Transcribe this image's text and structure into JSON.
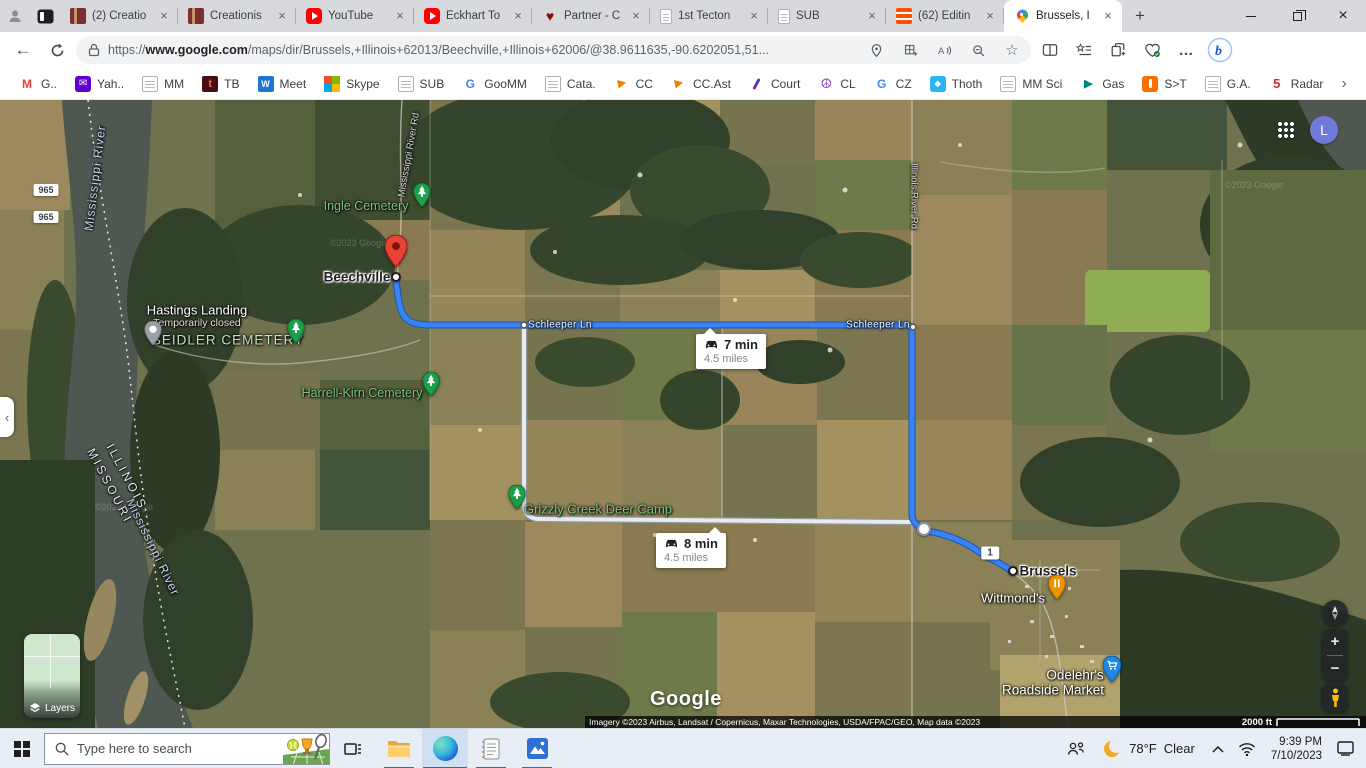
{
  "browser": {
    "tabs": [
      {
        "title": "(2) Creatio",
        "icon": "creation"
      },
      {
        "title": "Creationis",
        "icon": "creation"
      },
      {
        "title": "YouTube",
        "icon": "youtube"
      },
      {
        "title": "Eckhart To",
        "icon": "youtube"
      },
      {
        "title": "Partner - C",
        "icon": "heart"
      },
      {
        "title": "1st Tecton",
        "icon": "page"
      },
      {
        "title": "SUB",
        "icon": "page"
      },
      {
        "title": "(62) Editin",
        "icon": "flip"
      },
      {
        "title": "Brussels, I",
        "icon": "maps",
        "active": true
      }
    ],
    "glyphs": {
      "close": "×",
      "new_tab": "+",
      "back_arrow": "←",
      "overflow_dots": "…",
      "bookmarks_more": "›",
      "side_panel_collapse": "‹",
      "star": "☆",
      "split_screen": "◫"
    },
    "url": {
      "scheme": "https://",
      "host": "www.google.com",
      "path": "/maps/dir/Brussels,+Illinois+62013/Beechville,+Illinois+62006/@38.9611635,-90.6202051,51..."
    },
    "bing_label": "b",
    "bookmarks": [
      {
        "label": "G..",
        "icon": "gmail"
      },
      {
        "label": "Yah..",
        "icon": "mail-purple"
      },
      {
        "label": "MM",
        "icon": "page"
      },
      {
        "label": "TB",
        "icon": "tb"
      },
      {
        "label": "Meet",
        "icon": "w-blue"
      },
      {
        "label": "Skype",
        "icon": "ms"
      },
      {
        "label": "SUB",
        "icon": "page"
      },
      {
        "label": "GooMM",
        "icon": "google-g"
      },
      {
        "label": "Cata.",
        "icon": "page"
      },
      {
        "label": "CC",
        "icon": "arrow-orange"
      },
      {
        "label": "CC.Ast",
        "icon": "arrow-orange"
      },
      {
        "label": "Court",
        "icon": "feather"
      },
      {
        "label": "CL",
        "icon": "peace"
      },
      {
        "label": "CZ",
        "icon": "google-g"
      },
      {
        "label": "Thoth",
        "icon": "thoth"
      },
      {
        "label": "MM Sci",
        "icon": "page"
      },
      {
        "label": "Gas",
        "icon": "gas"
      },
      {
        "label": "S>T",
        "icon": "st"
      },
      {
        "label": "G.A.",
        "icon": "page"
      },
      {
        "label": "Radar",
        "icon": "five"
      }
    ]
  },
  "map": {
    "labels": {
      "mississippi_river": "Mississippi River",
      "mississippi_river_rd": "Mississippi River Rd",
      "illinois_river_rd": "Illinois River Rd",
      "ingle_cemetery": "Ingle Cemetery",
      "beechville": "Beechville",
      "hastings_landing": "Hastings Landing",
      "hastings_status": "Temporarily closed",
      "seidler_cemetery": "SEIDLER CEMETERY",
      "harrell_kirn_cemetery": "Harrell-Kirn Cemetery",
      "illinois": "ILLINOIS",
      "missouri": "MISSOURI",
      "schleeper_ln": "Schleeper Ln",
      "grizzly_creek": "Grizzly Creek Deer Camp",
      "brussels": "Brussels",
      "wittmonds": "Wittmond's",
      "odelehrs_line1": "Odelehr's",
      "odelehrs_line2": "Roadside Market"
    },
    "shields": {
      "route_965": "965",
      "route_1": "1"
    },
    "routes": {
      "primary": {
        "duration": "7 min",
        "distance": "4.5 miles"
      },
      "alternate": {
        "duration": "8 min",
        "distance": "4.5 miles"
      }
    },
    "controls": {
      "layers_label": "Layers",
      "zoom_in": "+",
      "zoom_out": "−"
    },
    "google_logo": "Google",
    "avatar_initial": "L",
    "attribution": {
      "imagery": "Imagery ©2023 Airbus, Landsat / Copernicus, Maxar Technologies, USDA/FPAC/GEO, Map data ©2023",
      "links": [
        "United States",
        "Terms",
        "Privacy",
        "Send feedback"
      ],
      "scale_text": "2000 ft"
    },
    "watermark": "©2023 Google"
  },
  "taskbar": {
    "search_placeholder": "Type here to search",
    "weather": {
      "temp": "78°F",
      "condition": "Clear"
    },
    "clock": {
      "time": "9:39 PM",
      "date": "7/10/2023"
    }
  },
  "colors": {
    "route_primary": "#3b82f6",
    "route_primary_casing": "#1557b0",
    "route_alternate": "#e8eaed",
    "avatar_bg": "#6f7bd9",
    "taskbar_run_indicator": "#0078d7",
    "cemetery_label": "#7cc47e",
    "destination_pin": "#ea4335"
  }
}
